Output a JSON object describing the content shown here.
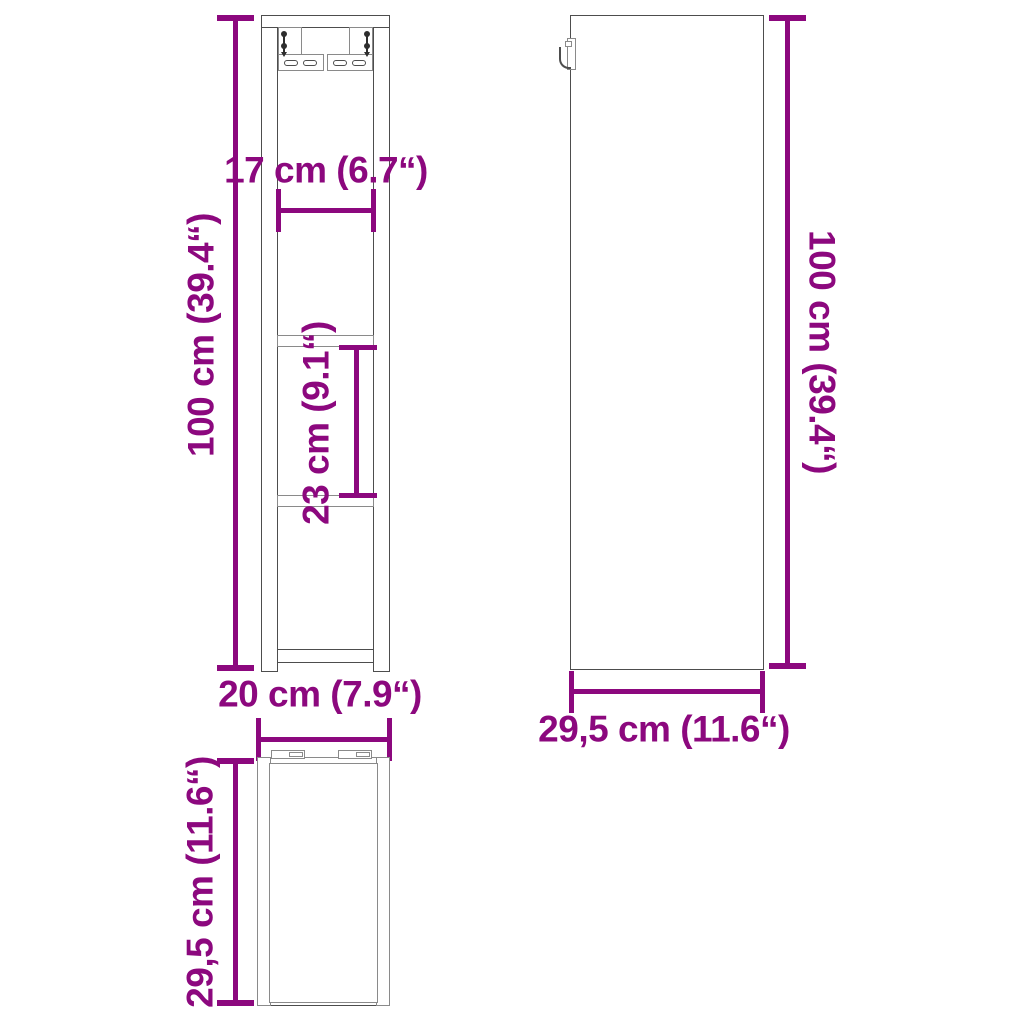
{
  "colors": {
    "dim": "#8C087E",
    "outline": "#4D4D4D",
    "outline-light": "#8A8A8A",
    "bg": "#FFFFFF"
  },
  "labels": {
    "front_inner_width": "17 cm (6.7“)",
    "front_height": "100 cm (39.4“)",
    "front_shelf_spacing": "23 cm (9.1“)",
    "front_width": "20 cm (7.9“)",
    "side_height": "100 cm (39.4“)",
    "side_depth": "29,5 cm (11.6“)",
    "top_depth": "29,5 cm (11.6“)"
  }
}
